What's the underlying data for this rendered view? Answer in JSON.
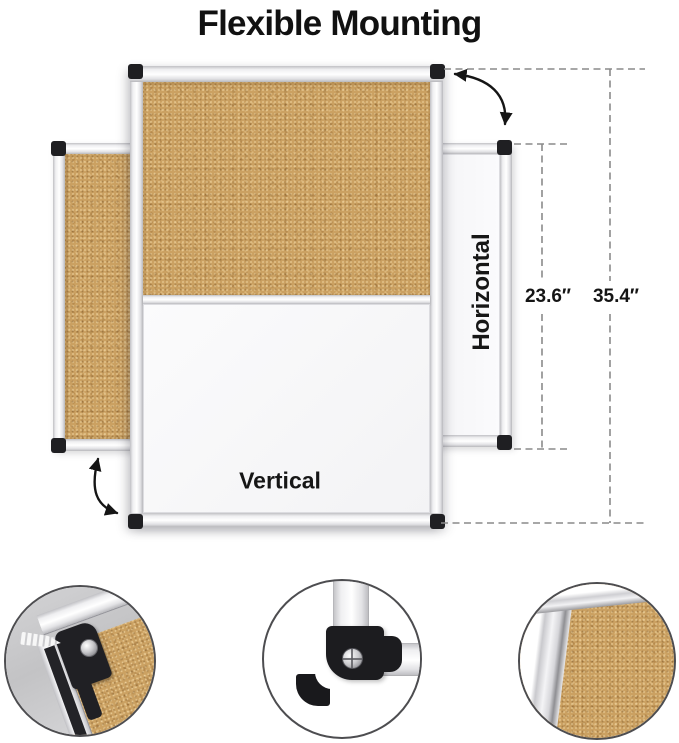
{
  "title": "Flexible Mounting",
  "board": {
    "vertical_label": "Vertical",
    "horizontal_label": "Horizontal"
  },
  "dimensions": {
    "board_width": "23.6″",
    "board_height": "35.4″"
  },
  "icons": {
    "rotate_arrow_top": "curved-rotation-arrow",
    "rotate_arrow_left": "curved-rotation-arrow",
    "corner_cap": "black-plastic-corner-cap",
    "detail_circles": [
      "wall-anchor-corner-mount",
      "corner-bracket-with-screw",
      "cork-surface-frame-closeup"
    ]
  },
  "colors": {
    "cork": "#cba162",
    "frame_silver": "#ececef",
    "corner_black": "#1f1f22",
    "dash_gray": "#8a8a8a",
    "arrow_black": "#151515",
    "text": "#111111",
    "wall_gray": "#c8c8ca"
  }
}
